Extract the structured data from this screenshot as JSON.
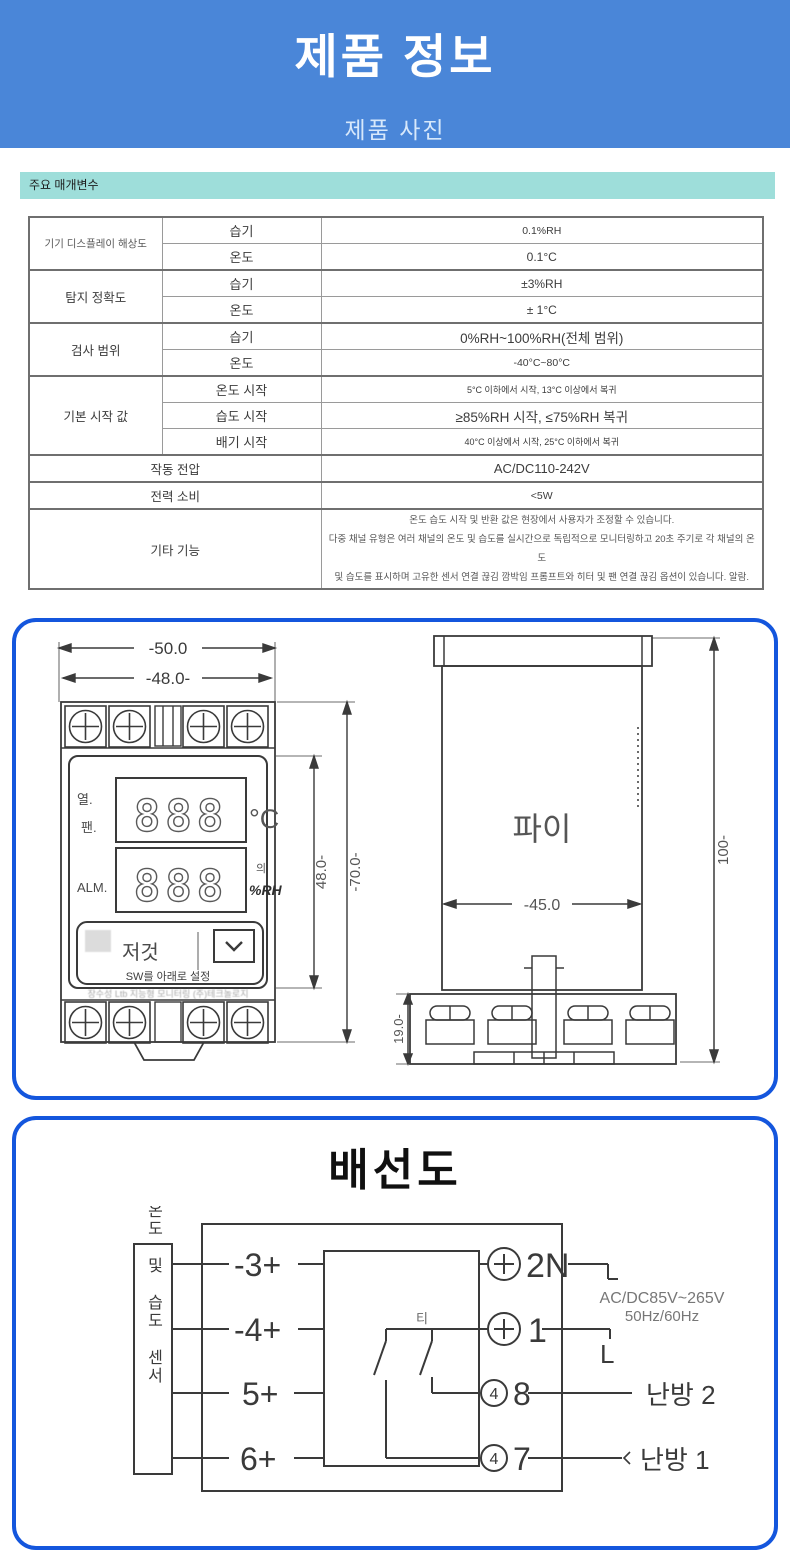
{
  "header": {
    "title": "제품 정보",
    "subtitle": "제품 사진"
  },
  "params": {
    "section_label": "주요 매개변수",
    "groups": [
      {
        "category": "기기 디스플레이 해상도",
        "items": [
          {
            "sub": "습기",
            "value": "0.1%RH"
          },
          {
            "sub": "온도",
            "value": "0.1°C"
          }
        ]
      },
      {
        "category": "탐지 정확도",
        "items": [
          {
            "sub": "습기",
            "value": "±3%RH"
          },
          {
            "sub": "온도",
            "value": "± 1°C"
          }
        ]
      },
      {
        "category": "검사 범위",
        "items": [
          {
            "sub": "습기",
            "value": "0%RH~100%RH(전체 범위)"
          },
          {
            "sub": "온도",
            "value": "-40°C~80°C"
          }
        ]
      },
      {
        "category": "기본 시작 값",
        "items": [
          {
            "sub": "온도 시작",
            "value": "5°C 이하에서 시작, 13°C 이상에서 복귀"
          },
          {
            "sub": "습도 시작",
            "value": "≥85%RH 시작, ≤75%RH 복귀"
          },
          {
            "sub": "배기 시작",
            "value": "40°C 이상에서 시작, 25°C 이하에서 복귀"
          }
        ]
      }
    ],
    "voltage": {
      "label": "작동 전압",
      "value": "AC/DC110-242V"
    },
    "power": {
      "label": "전력 소비",
      "value": "<5W"
    },
    "other": {
      "label": "기타 기능",
      "line1": "온도 습도 시작 및 반환 값은 현장에서 사용자가 조정할 수 있습니다.",
      "line2": "다중 채널 유형은 여러 채널의 온도 및 습도를 실시간으로 독립적으로 모니터링하고 20초 주기로 각 채널의 온도",
      "line3": "및 습도를 표시하며 고유한 센서 연결 끊김 깜박임 프롬프트와 히터 및 팬 연결 끊김 옵션이 있습니다. 알람."
    }
  },
  "dimensions": {
    "front": {
      "dim_outer_width": "-50.0",
      "dim_inner_width": "-48.0-",
      "dim_display_height": "48.0-",
      "dim_body_height": "-70.0-",
      "label_heat": "열.",
      "label_fan": "팬.",
      "label_alarm": "ALM.",
      "digits_top": "888",
      "digits_bottom": "888",
      "unit_temp": "°C",
      "unit_humidity": "%RH",
      "unit_humidity_tag": "의",
      "label_set": "저것",
      "label_sw_set": "SW를 아래로 설정",
      "watermark": "장수성 Ltb 지능형 모니터링 (주)테크놀로지"
    },
    "side": {
      "body_label": "파이",
      "dim_height": "100-",
      "dim_width": "-45.0",
      "dim_terminal_height": "19.0-"
    }
  },
  "wiring": {
    "title": "배선도",
    "sensor_label": "양방향 온도 및 습도 센서",
    "terminals_left": [
      {
        "label": "-3+"
      },
      {
        "label": "-4+"
      },
      {
        "label": "5+"
      },
      {
        "label": "6+"
      }
    ],
    "terminals_right": [
      {
        "label": "2N"
      },
      {
        "label": "1"
      },
      {
        "label": "8"
      },
      {
        "label": "7"
      }
    ],
    "circle_digit": "4",
    "switch_label": "티",
    "power_rating_line1": "AC/DC85V~265V",
    "power_rating_line2": "50Hz/60Hz",
    "live_label": "L",
    "load_top": "난방 2",
    "load_bottom": "난방 1"
  },
  "colors": {
    "header_bg": "#4a86d8",
    "section_bg": "#9ededa",
    "panel_border": "#1456dd"
  }
}
